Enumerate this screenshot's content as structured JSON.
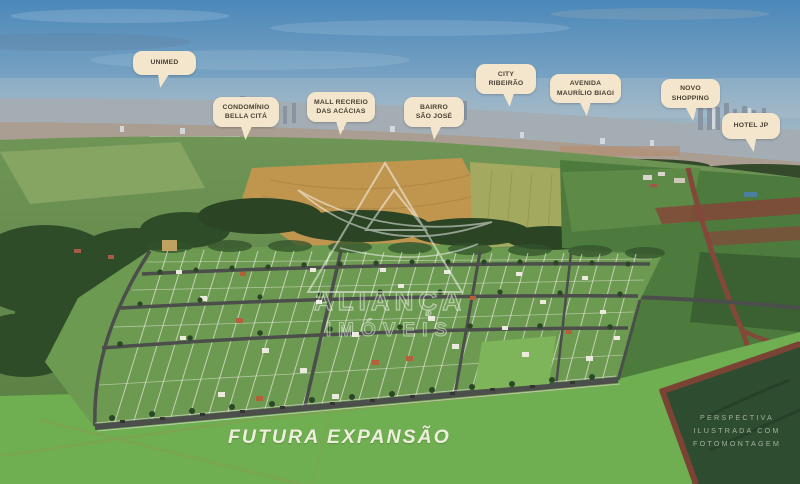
{
  "scene": {
    "title": "Aerial photomontage of residential development with landmark callouts",
    "watermark": {
      "line1": "ALIANÇA",
      "line2": "IMÓVEIS"
    },
    "future_expansion_label": "FUTURA EXPANSÃO",
    "disclaimer": {
      "line1": "PERSPECTIVA",
      "line2": "ILUSTRADA COM",
      "line3": "FOTOMONTAGEM"
    }
  },
  "callouts": [
    {
      "id": "unimed",
      "label": "UNIMED"
    },
    {
      "id": "condominio-bella-cita",
      "label": "CONDOMÍNIO BELLA CITÁ"
    },
    {
      "id": "mall-recreio-acacias",
      "label": "MALL RECREIO DAS ACÁCIAS"
    },
    {
      "id": "bairro-sao-jose",
      "label": "BAIRRO SÃO JOSÉ"
    },
    {
      "id": "city-ribeirao",
      "label": "CITY RIBEIRÃO"
    },
    {
      "id": "avenida-maurilio-biagi",
      "label": "AVENIDA MAURÍLIO BIAGI"
    },
    {
      "id": "novo-shopping",
      "label": "NOVO SHOPPING"
    },
    {
      "id": "hotel-jp",
      "label": "HOTEL JP"
    }
  ],
  "colors": {
    "bubble": "#f3e6cd",
    "bubble_text": "#4a4134",
    "expansion_label": "#eeeedd",
    "disclaimer": "#b6c2b3",
    "watermark": "#ffffff",
    "sky_top": "#4b88ba",
    "grass_bright": "#6fae51",
    "field_dark": "#2e4c30",
    "dirt_red": "#7b4334",
    "development_green": "#6d9a51"
  }
}
